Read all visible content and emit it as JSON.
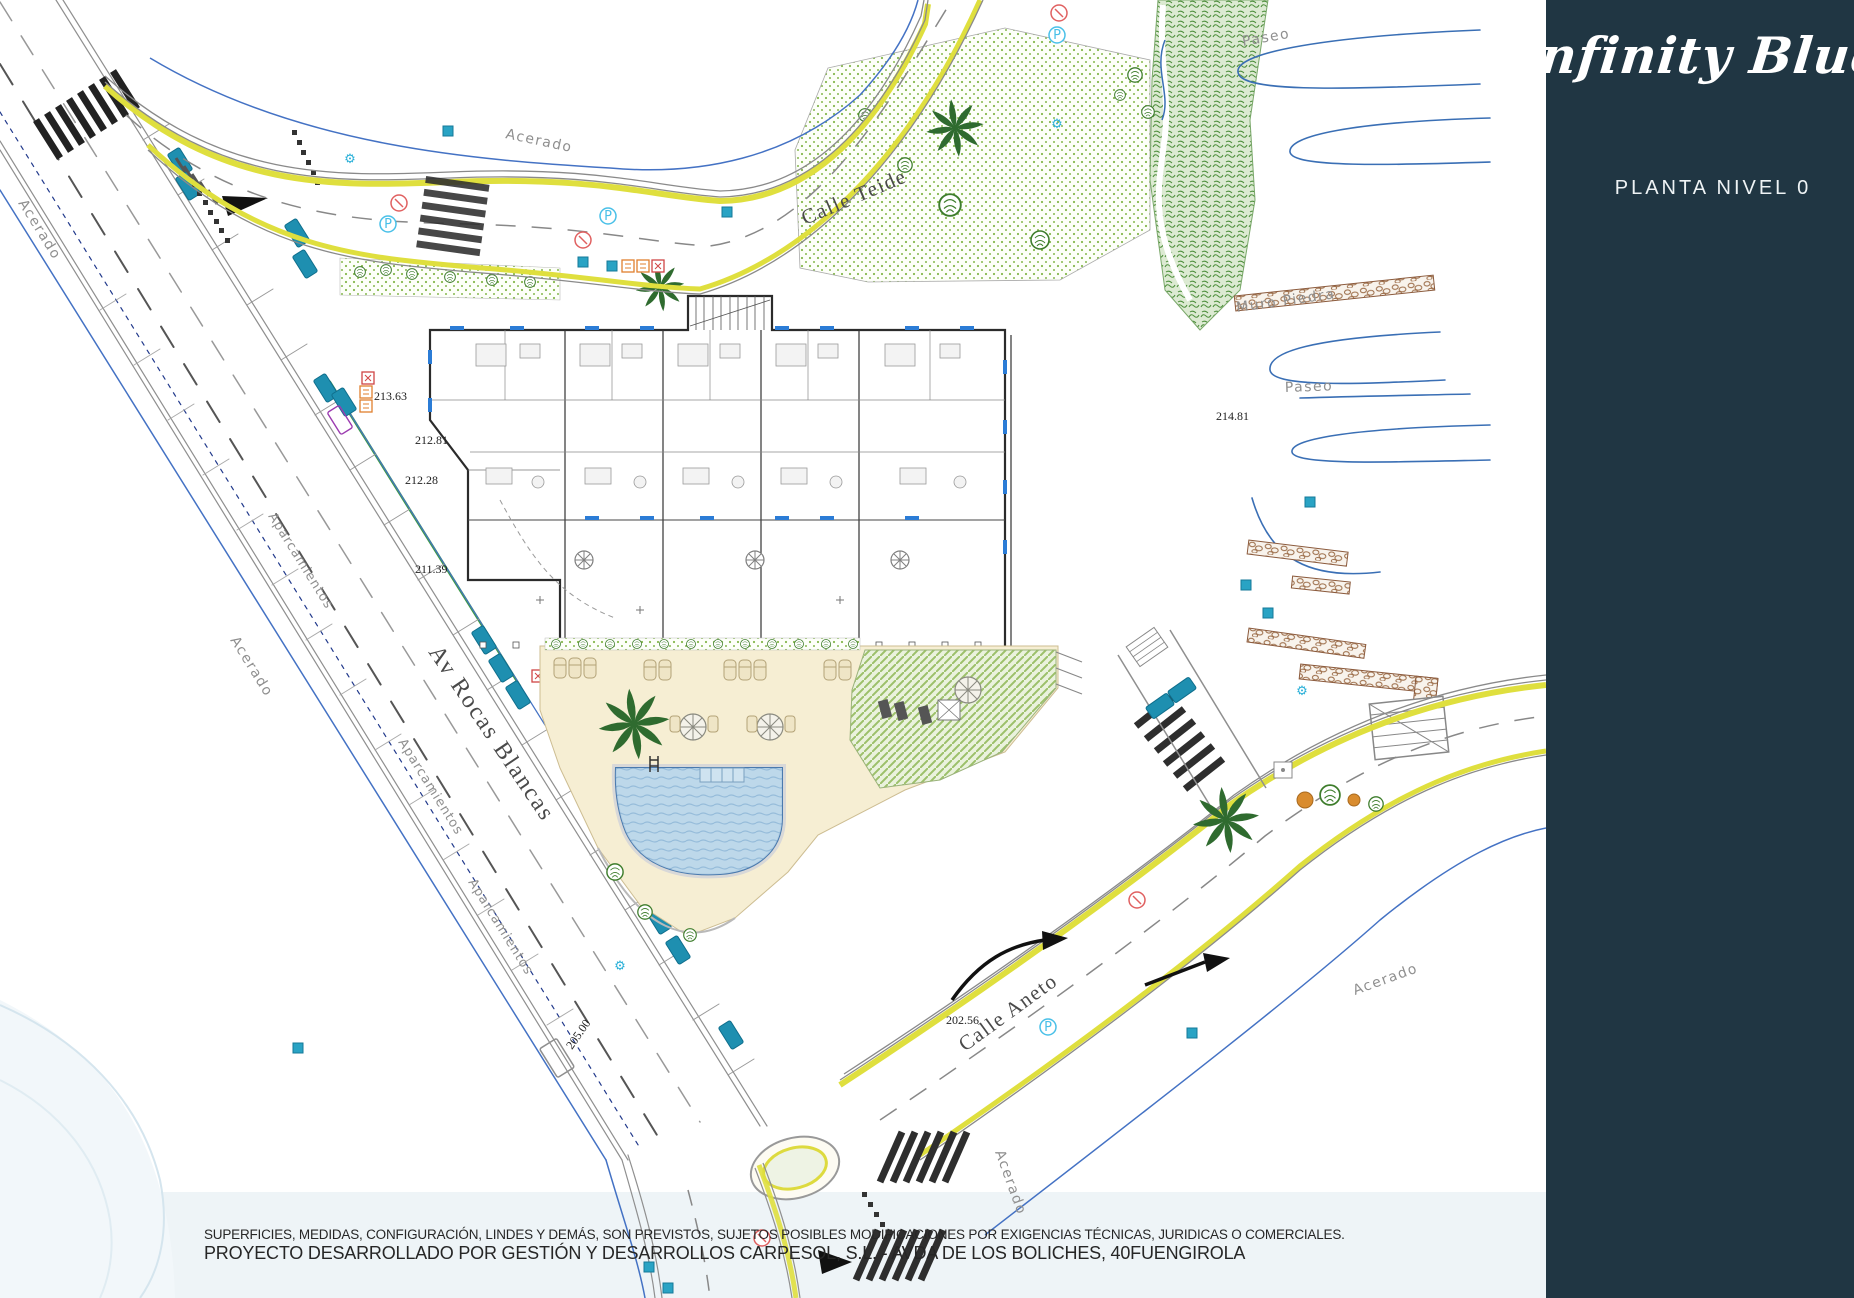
{
  "sidebar": {
    "logo": "Infinity Blue",
    "plan_label": "PLANTA NIVEL 0"
  },
  "footer": {
    "line1": "SUPERFICIES, MEDIDAS, CONFIGURACIÓN, LINDES Y DEMÁS, SON PREVISTOS, SUJETOS POSIBLES MODIFICACIONES POR EXIGENCIAS TÉCNICAS, JURIDICAS O COMERCIALES.",
    "line2": "PROYECTO DESARROLLADO POR GESTIÓN Y DESARROLLOS CARPESOL, S.L. - AVDA DE LOS BOLICHES, 40FUENGIROLA"
  },
  "plan": {
    "streets": {
      "teide": "Calle Teide",
      "aneto": "Calle Aneto",
      "rocas_blancas": "Av Rocas Blancas"
    },
    "labels": {
      "acerado": "Acerado",
      "aparcamientos": "Aparcamientos",
      "paseo": "Paseo",
      "muro_piedra": "Muro Piedra"
    },
    "elevations": {
      "e1": "213.63",
      "e2": "212.81",
      "e3": "212.28",
      "e4": "211.39",
      "e5": "214.81",
      "e6": "205.00",
      "e7": "202.56"
    },
    "icons": {
      "parking": "P",
      "gear": "⚙"
    }
  },
  "colors": {
    "sidebar_bg": "#203643",
    "road_yellow": "#dfdf3e",
    "drawing_blue": "#4472c4",
    "water_blue": "#bdd8ea",
    "deck_beige": "#f6eed3",
    "accent_teal": "#29a3c4"
  }
}
